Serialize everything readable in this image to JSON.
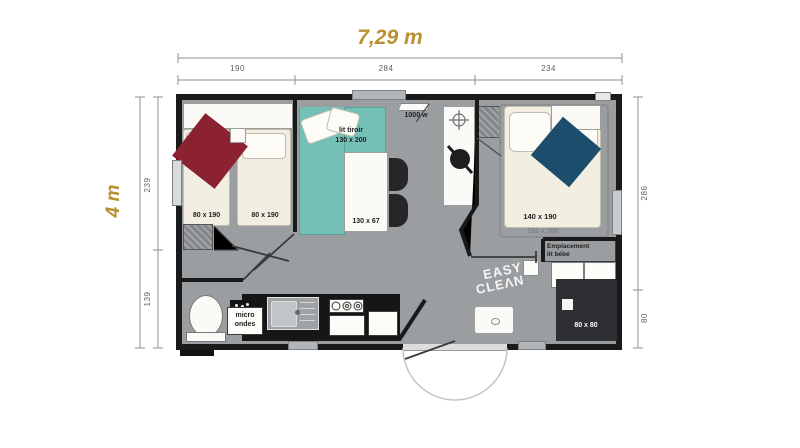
{
  "dims": {
    "width_total": "7,29 m",
    "height_total": "4 m",
    "top": [
      "190",
      "284",
      "234"
    ],
    "left": [
      "239",
      "139"
    ],
    "right": [
      "286",
      "80"
    ]
  },
  "labels": {
    "beds_single": [
      "80 x 190",
      "80 x 190"
    ],
    "sofa_l1": "lit tiroir",
    "sofa_l2": "130 x 200",
    "table": "130 x 67",
    "heater": "1000 w",
    "bed_double": "140 x 190",
    "bed_double_alt": "160 x 200",
    "baby_l1": "Emplacement",
    "baby_l2": "lit bébé",
    "micro_l1": "micro",
    "micro_l2": "ondes",
    "logo_l1": "EASY",
    "logo_l2": "CLEΛN",
    "shower": "80 x 80"
  },
  "colors": {
    "accent_gold": "#b98f2f",
    "floor_gray": "#9b9ea1",
    "wall_black": "#1a1a1a",
    "bed_cream": "#f2efe2",
    "sofa_teal": "#74c0b6",
    "blanket_red": "#8c2130",
    "blanket_blue": "#1d4d6d",
    "counter_dark": "#161616",
    "shower_dark": "#2e2f32"
  }
}
